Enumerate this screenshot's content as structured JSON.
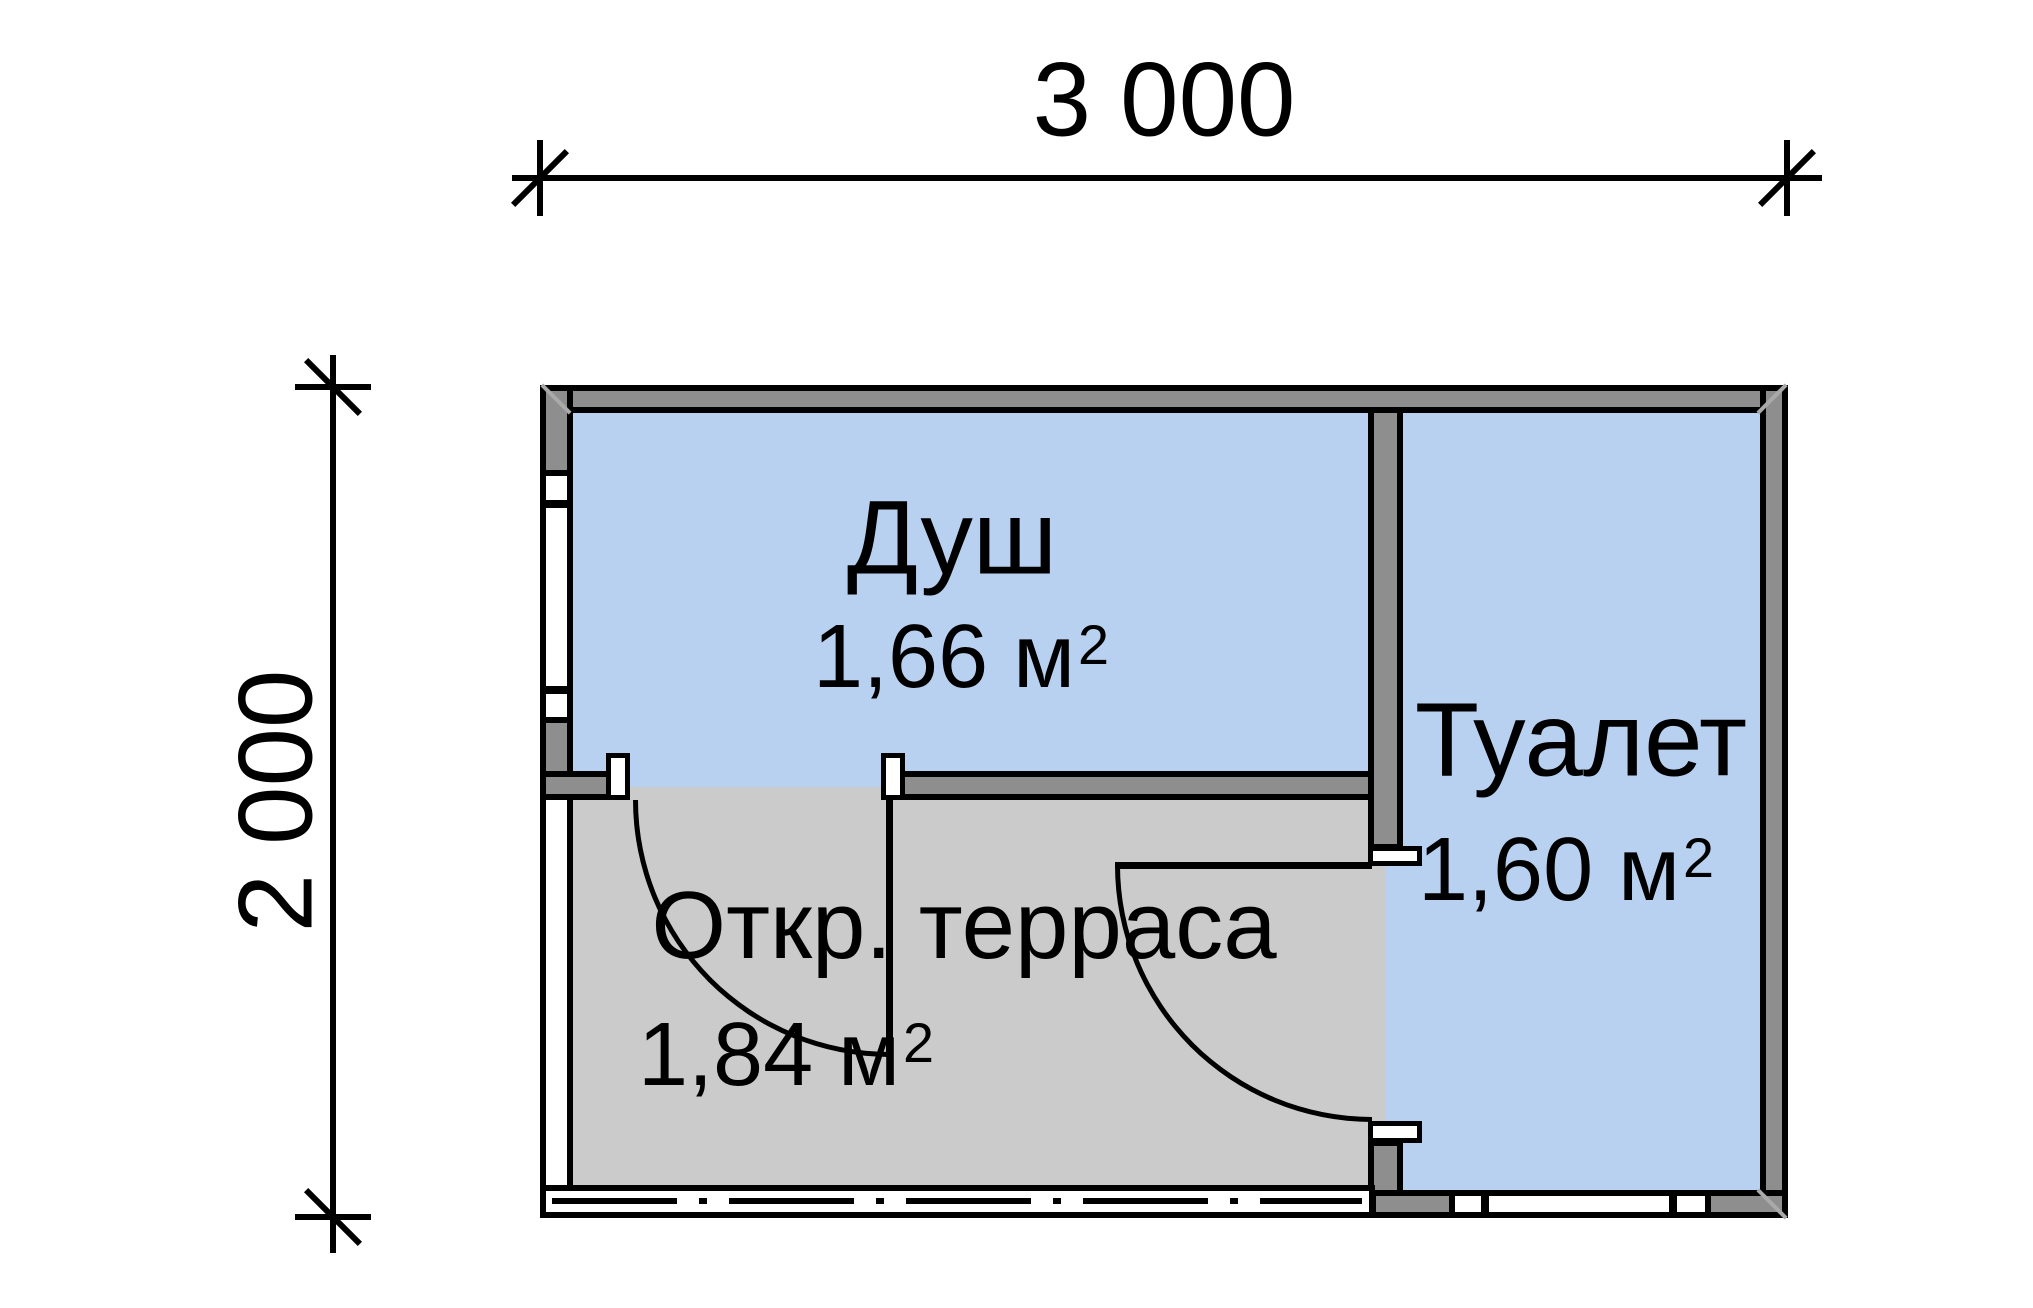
{
  "plan": {
    "dimensions": {
      "width_label": "3 000",
      "height_label": "2 000"
    },
    "rooms": [
      {
        "name": "Душ",
        "area_value": "1,66 м",
        "area_exponent": "2"
      },
      {
        "name": "Туалет",
        "area_value": "1,60 м",
        "area_exponent": "2"
      },
      {
        "name": "Откр. терраса",
        "area_value": "1,84 м",
        "area_exponent": "2"
      }
    ],
    "colors": {
      "wall_fill": "#8e8e8e",
      "room_fill": "#b8d1f0",
      "terrace_fill": "#cbcbcb",
      "line": "#000000",
      "background": "#ffffff"
    }
  }
}
